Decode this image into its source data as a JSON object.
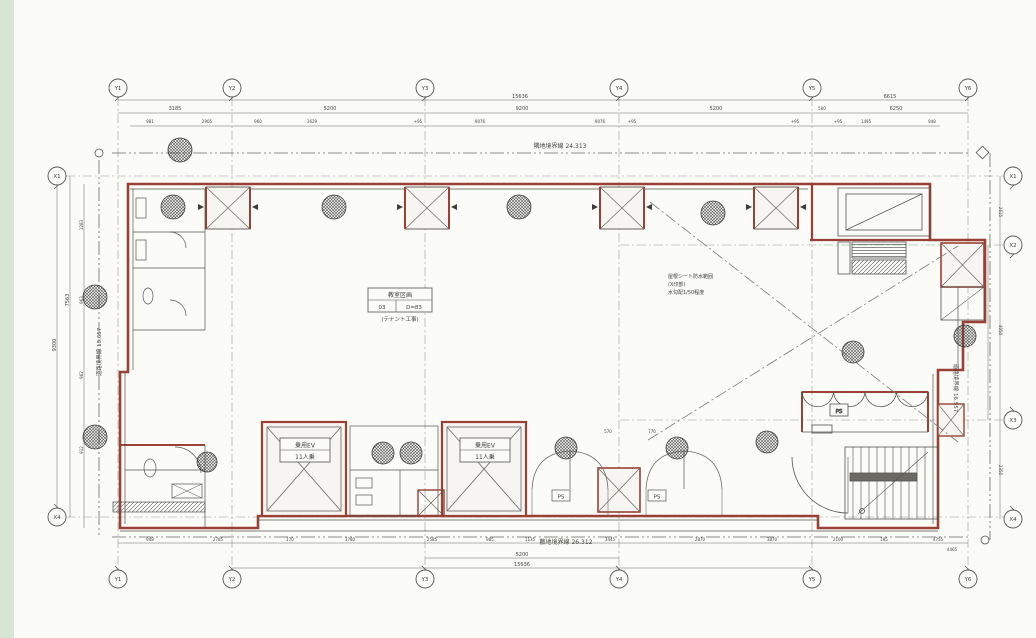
{
  "document": {
    "type": "architectural-floor-plan-scan",
    "canvas": {
      "width": 1036,
      "height": 638,
      "bg": "#f2f3ee",
      "left_strip_color": "#d8e5d2",
      "paper_color": "#fbfbf8"
    },
    "colors": {
      "wall_red": "#9a4034",
      "line": "#55534e",
      "dim_text": "#46453f",
      "grid_line": "#9a9a94"
    }
  },
  "grid_bubbles": [
    {
      "label": "Y1",
      "x": 118,
      "y": 88
    },
    {
      "label": "Y2",
      "x": 232,
      "y": 88
    },
    {
      "label": "Y3",
      "x": 425,
      "y": 88
    },
    {
      "label": "Y4",
      "x": 619,
      "y": 88
    },
    {
      "label": "Y5",
      "x": 812,
      "y": 88
    },
    {
      "label": "Y6",
      "x": 968,
      "y": 88
    },
    {
      "label": "Y1",
      "x": 118,
      "y": 579
    },
    {
      "label": "Y2",
      "x": 232,
      "y": 579
    },
    {
      "label": "Y3",
      "x": 425,
      "y": 579
    },
    {
      "label": "Y4",
      "x": 619,
      "y": 579
    },
    {
      "label": "Y5",
      "x": 812,
      "y": 579
    },
    {
      "label": "Y6",
      "x": 968,
      "y": 579
    },
    {
      "label": "X1",
      "x": 57,
      "y": 176
    },
    {
      "label": "X4",
      "x": 57,
      "y": 517
    },
    {
      "label": "X1",
      "x": 1013,
      "y": 176
    },
    {
      "label": "X2",
      "x": 1013,
      "y": 245
    },
    {
      "label": "X3",
      "x": 1013,
      "y": 420
    },
    {
      "label": "X4",
      "x": 1013,
      "y": 519
    }
  ],
  "boundary_labels": [
    {
      "text": "隣地境界線  24.313",
      "x": 560,
      "y": 148,
      "size": 6,
      "rot": 0
    },
    {
      "text": "敷地境界線  26.312",
      "x": 566,
      "y": 544,
      "size": 6,
      "rot": 0
    },
    {
      "text": "道路境界線 18.657",
      "x": 101,
      "y": 352,
      "size": 5.5,
      "rot": -90
    },
    {
      "text": "道路境界線 16.557",
      "x": 954,
      "y": 388,
      "size": 5.5,
      "rot": 90
    }
  ],
  "annotations": {
    "zone_box": {
      "line1": "教室区画",
      "cell_a": "03",
      "cell_b": "D=83",
      "line3": "(テナント工事)"
    },
    "roof_note": {
      "line1": "屋根シート防水範囲",
      "line2": "(X印部)",
      "line3": "水勾配1/50程度"
    },
    "elevator_label": {
      "line1": "乗用EV",
      "line2": "11人乗"
    },
    "ps_label": "PS"
  },
  "dim_labels": [
    {
      "t": "15636",
      "x": 520,
      "y": 98
    },
    {
      "t": "6615",
      "x": 890,
      "y": 98
    },
    {
      "t": "3185",
      "x": 175,
      "y": 110
    },
    {
      "t": "5200",
      "x": 330,
      "y": 110
    },
    {
      "t": "9200",
      "x": 522,
      "y": 110
    },
    {
      "t": "5200",
      "x": 716,
      "y": 110
    },
    {
      "t": "6250",
      "x": 896,
      "y": 110
    },
    {
      "t": "500",
      "x": 822,
      "y": 110,
      "s": 4
    },
    {
      "t": "981",
      "x": 150,
      "y": 123,
      "s": 4
    },
    {
      "t": "2905",
      "x": 207,
      "y": 123,
      "s": 4
    },
    {
      "t": "960",
      "x": 258,
      "y": 123,
      "s": 4
    },
    {
      "t": "1629",
      "x": 312,
      "y": 123,
      "s": 4
    },
    {
      "t": "+95",
      "x": 418,
      "y": 123,
      "s": 4
    },
    {
      "t": "9076",
      "x": 480,
      "y": 123,
      "s": 4
    },
    {
      "t": "9076",
      "x": 600,
      "y": 123,
      "s": 4
    },
    {
      "t": "+95",
      "x": 632,
      "y": 123,
      "s": 4
    },
    {
      "t": "+95",
      "x": 795,
      "y": 123,
      "s": 4
    },
    {
      "t": "+95",
      "x": 838,
      "y": 123,
      "s": 4
    },
    {
      "t": "1495",
      "x": 866,
      "y": 123,
      "s": 4
    },
    {
      "t": "948",
      "x": 932,
      "y": 123,
      "s": 4
    },
    {
      "t": "948",
      "x": 150,
      "y": 541,
      "s": 4
    },
    {
      "t": "2785",
      "x": 218,
      "y": 541,
      "s": 4
    },
    {
      "t": "170",
      "x": 290,
      "y": 541,
      "s": 4
    },
    {
      "t": "3780",
      "x": 350,
      "y": 541,
      "s": 4
    },
    {
      "t": "2585",
      "x": 432,
      "y": 541,
      "s": 4
    },
    {
      "t": "985",
      "x": 490,
      "y": 541,
      "s": 4
    },
    {
      "t": "1135",
      "x": 530,
      "y": 541,
      "s": 4
    },
    {
      "t": "3445",
      "x": 610,
      "y": 541,
      "s": 4
    },
    {
      "t": "2870",
      "x": 700,
      "y": 541,
      "s": 4
    },
    {
      "t": "3870",
      "x": 772,
      "y": 541,
      "s": 4
    },
    {
      "t": "2100",
      "x": 838,
      "y": 541,
      "s": 4
    },
    {
      "t": "185",
      "x": 884,
      "y": 541,
      "s": 4
    },
    {
      "t": "4755",
      "x": 938,
      "y": 541,
      "s": 4
    },
    {
      "t": "4465",
      "x": 952,
      "y": 551,
      "s": 4
    },
    {
      "t": "5200",
      "x": 522,
      "y": 556
    },
    {
      "t": "15636",
      "x": 522,
      "y": 566
    },
    {
      "t": "9300",
      "x": 56,
      "y": 345,
      "rot": -90
    },
    {
      "t": "7563",
      "x": 69,
      "y": 300,
      "rot": -90
    },
    {
      "t": "1283",
      "x": 83,
      "y": 225,
      "rot": -90,
      "s": 4
    },
    {
      "t": "963",
      "x": 83,
      "y": 300,
      "rot": -90,
      "s": 4
    },
    {
      "t": "962",
      "x": 83,
      "y": 375,
      "rot": -90,
      "s": 4
    },
    {
      "t": "912",
      "x": 83,
      "y": 450,
      "rot": -90,
      "s": 4
    },
    {
      "t": "2615",
      "x": 999,
      "y": 212,
      "rot": 90,
      "s": 4
    },
    {
      "t": "4050",
      "x": 999,
      "y": 330,
      "rot": 90,
      "s": 4
    },
    {
      "t": "2350",
      "x": 999,
      "y": 470,
      "rot": 90,
      "s": 4
    },
    {
      "t": "570",
      "x": 608,
      "y": 433,
      "s": 4
    },
    {
      "t": "770",
      "x": 652,
      "y": 433,
      "s": 4
    }
  ]
}
